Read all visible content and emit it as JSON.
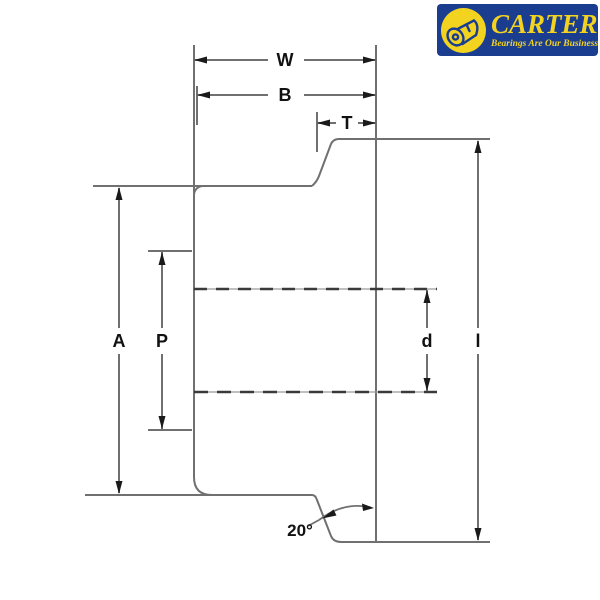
{
  "logo": {
    "brand": "CARTER",
    "tagline": "Bearings Are Our Business",
    "background_color": "#1b3d8f",
    "text_color": "#f2d320"
  },
  "diagram": {
    "type": "engineering-cross-section",
    "line_color": "#707070",
    "label_color": "#111111",
    "dimensions": {
      "W": "W",
      "B": "B",
      "T": "T",
      "A": "A",
      "P": "P",
      "d": "d",
      "l": "l",
      "angle": "20°"
    }
  }
}
